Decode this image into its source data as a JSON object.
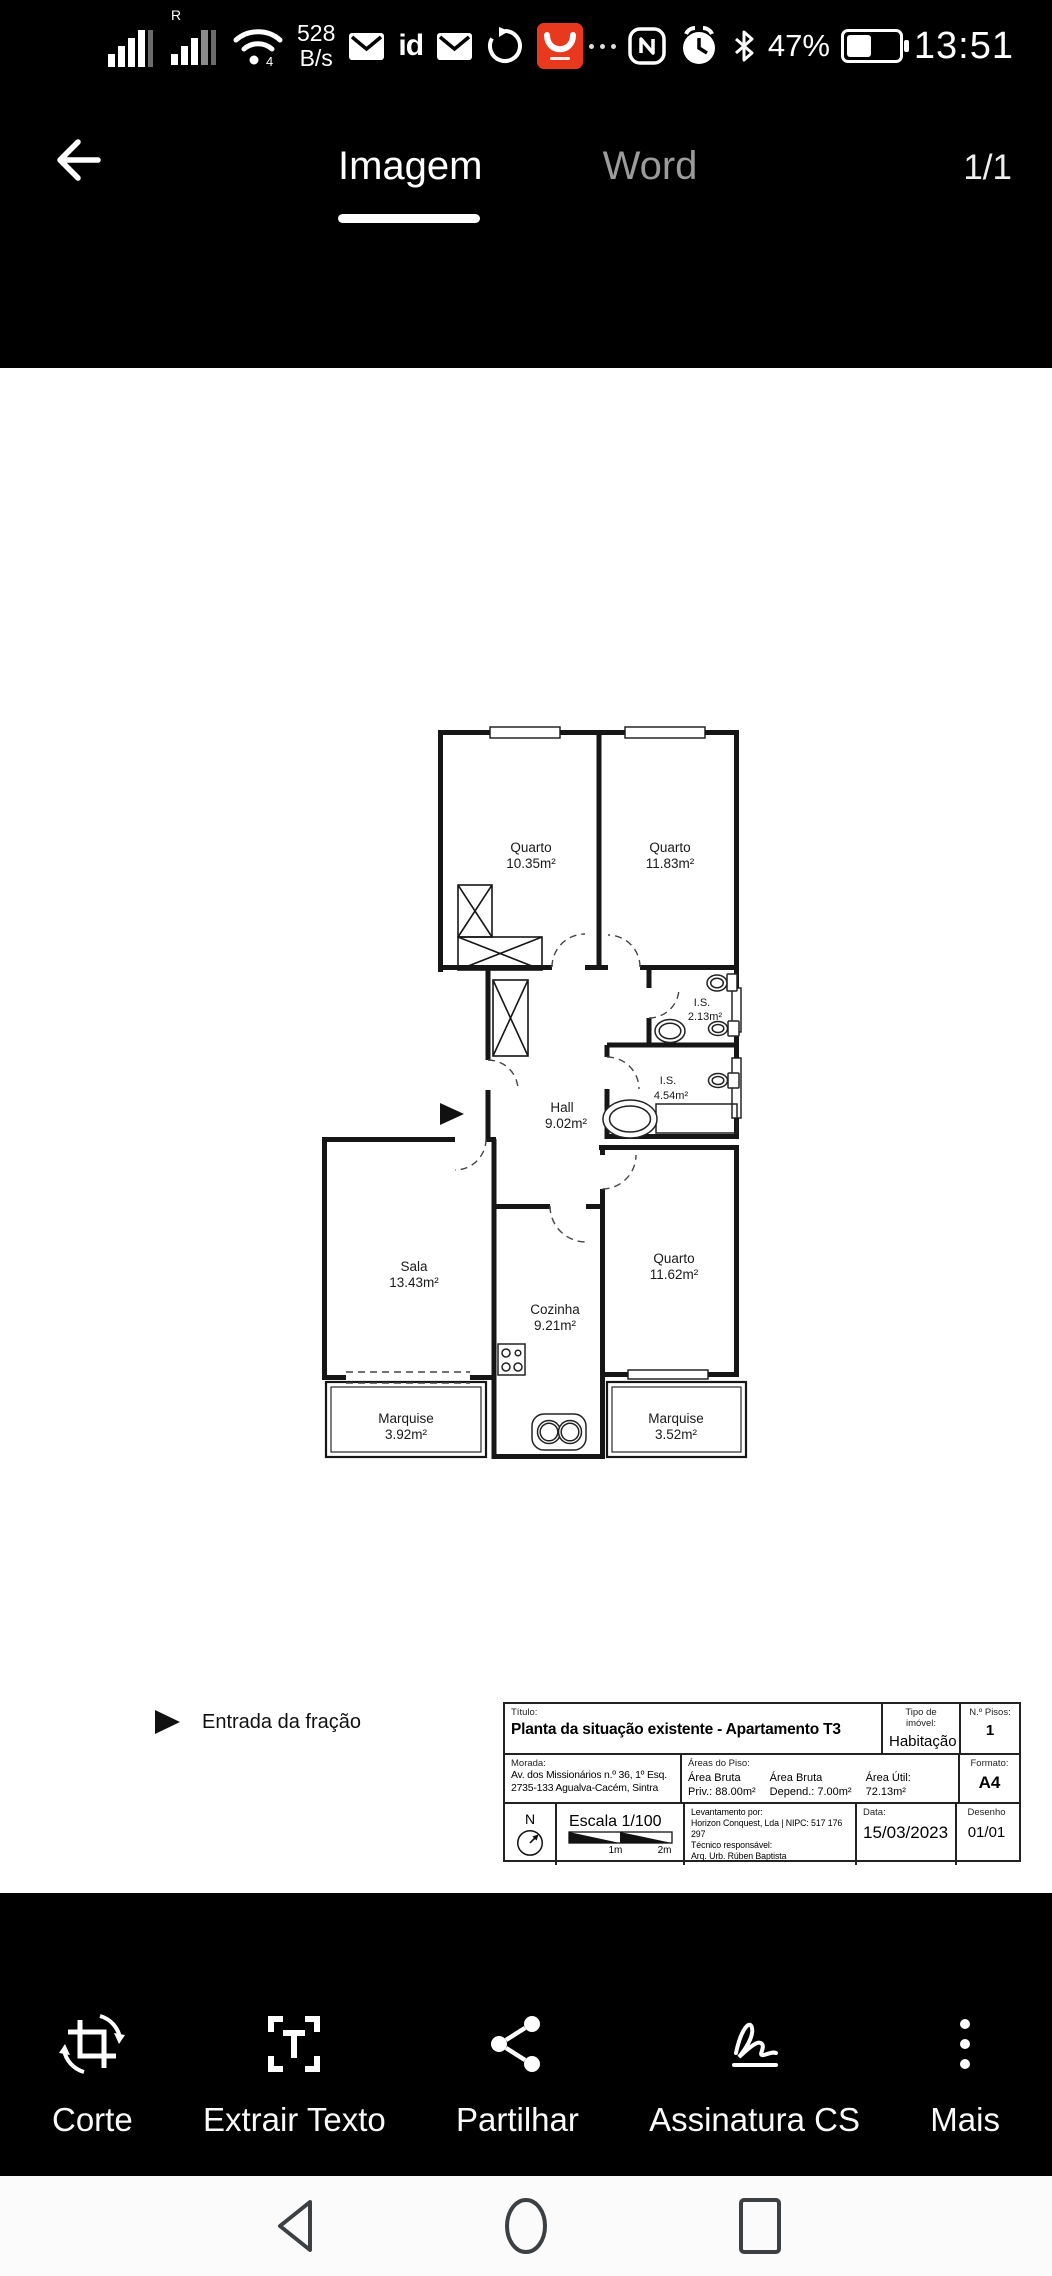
{
  "status_bar": {
    "roaming": "R",
    "network_speed_value": "528",
    "network_speed_unit": "B/s",
    "id_badge": "id",
    "battery_percent": "47%",
    "time": "13:51"
  },
  "app_bar": {
    "tabs": [
      {
        "label": "Imagem",
        "active": true
      },
      {
        "label": "Word",
        "active": false
      }
    ],
    "page_indicator": "1/1"
  },
  "floor_plan": {
    "entrance_label": "Entrada da fração",
    "rooms": [
      {
        "name": "Quarto",
        "area": "10.35m²"
      },
      {
        "name": "Quarto",
        "area": "11.83m²"
      },
      {
        "name": "I.S.",
        "area": "2.13m²"
      },
      {
        "name": "I.S.",
        "area": "4.54m²"
      },
      {
        "name": "Hall",
        "area": "9.02m²"
      },
      {
        "name": "Sala",
        "area": "13.43m²"
      },
      {
        "name": "Cozinha",
        "area": "9.21m²"
      },
      {
        "name": "Quarto",
        "area": "11.62m²"
      },
      {
        "name": "Marquise",
        "area": "3.92m²"
      },
      {
        "name": "Marquise",
        "area": "3.52m²"
      }
    ]
  },
  "title_block": {
    "titulo_label": "Título:",
    "title": "Planta da situação existente - Apartamento T3",
    "tipo_label": "Tipo de imóvel:",
    "tipo_value": "Habitação",
    "pisos_label": "N.º Pisos:",
    "pisos_value": "1",
    "morada_label": "Morada:",
    "morada_line1": "Av. dos Missionários n.º 36, 1º Esq.",
    "morada_line2": "2735-133 Agualva-Cacém, Sintra",
    "areas_label": "Áreas do Piso:",
    "areas": [
      {
        "l1": "Área Bruta",
        "l2": "Priv.: 88.00m²"
      },
      {
        "l1": "Área Bruta",
        "l2": "Depend.: 7.00m²"
      },
      {
        "l1": "Área Útil:",
        "l2": "72.13m²"
      }
    ],
    "formato_label": "Formato:",
    "formato_value": "A4",
    "north_label": "N",
    "escala": "Escala 1/100",
    "scale_tick1": "1m",
    "scale_tick2": "2m",
    "levantamento_label": "Levantamento por:",
    "levantamento_value": "Horizon Conquest, Lda | NIPC: 517 176 297",
    "tecnico_label": "Técnico responsável:",
    "tecnico_value": "Arq. Urb. Rúben Baptista",
    "data_label": "Data:",
    "data_value": "15/03/2023",
    "desenho_label": "Desenho",
    "desenho_value": "01/01"
  },
  "toolbar": {
    "items": [
      {
        "label": "Corte"
      },
      {
        "label": "Extrair Texto"
      },
      {
        "label": "Partilhar"
      },
      {
        "label": "Assinatura CS"
      },
      {
        "label": "Mais"
      }
    ]
  },
  "colors": {
    "accent_red": "#e8391f",
    "bar_bg": "#000000",
    "content_bg": "#ffffff",
    "plan_line": "#161616"
  }
}
